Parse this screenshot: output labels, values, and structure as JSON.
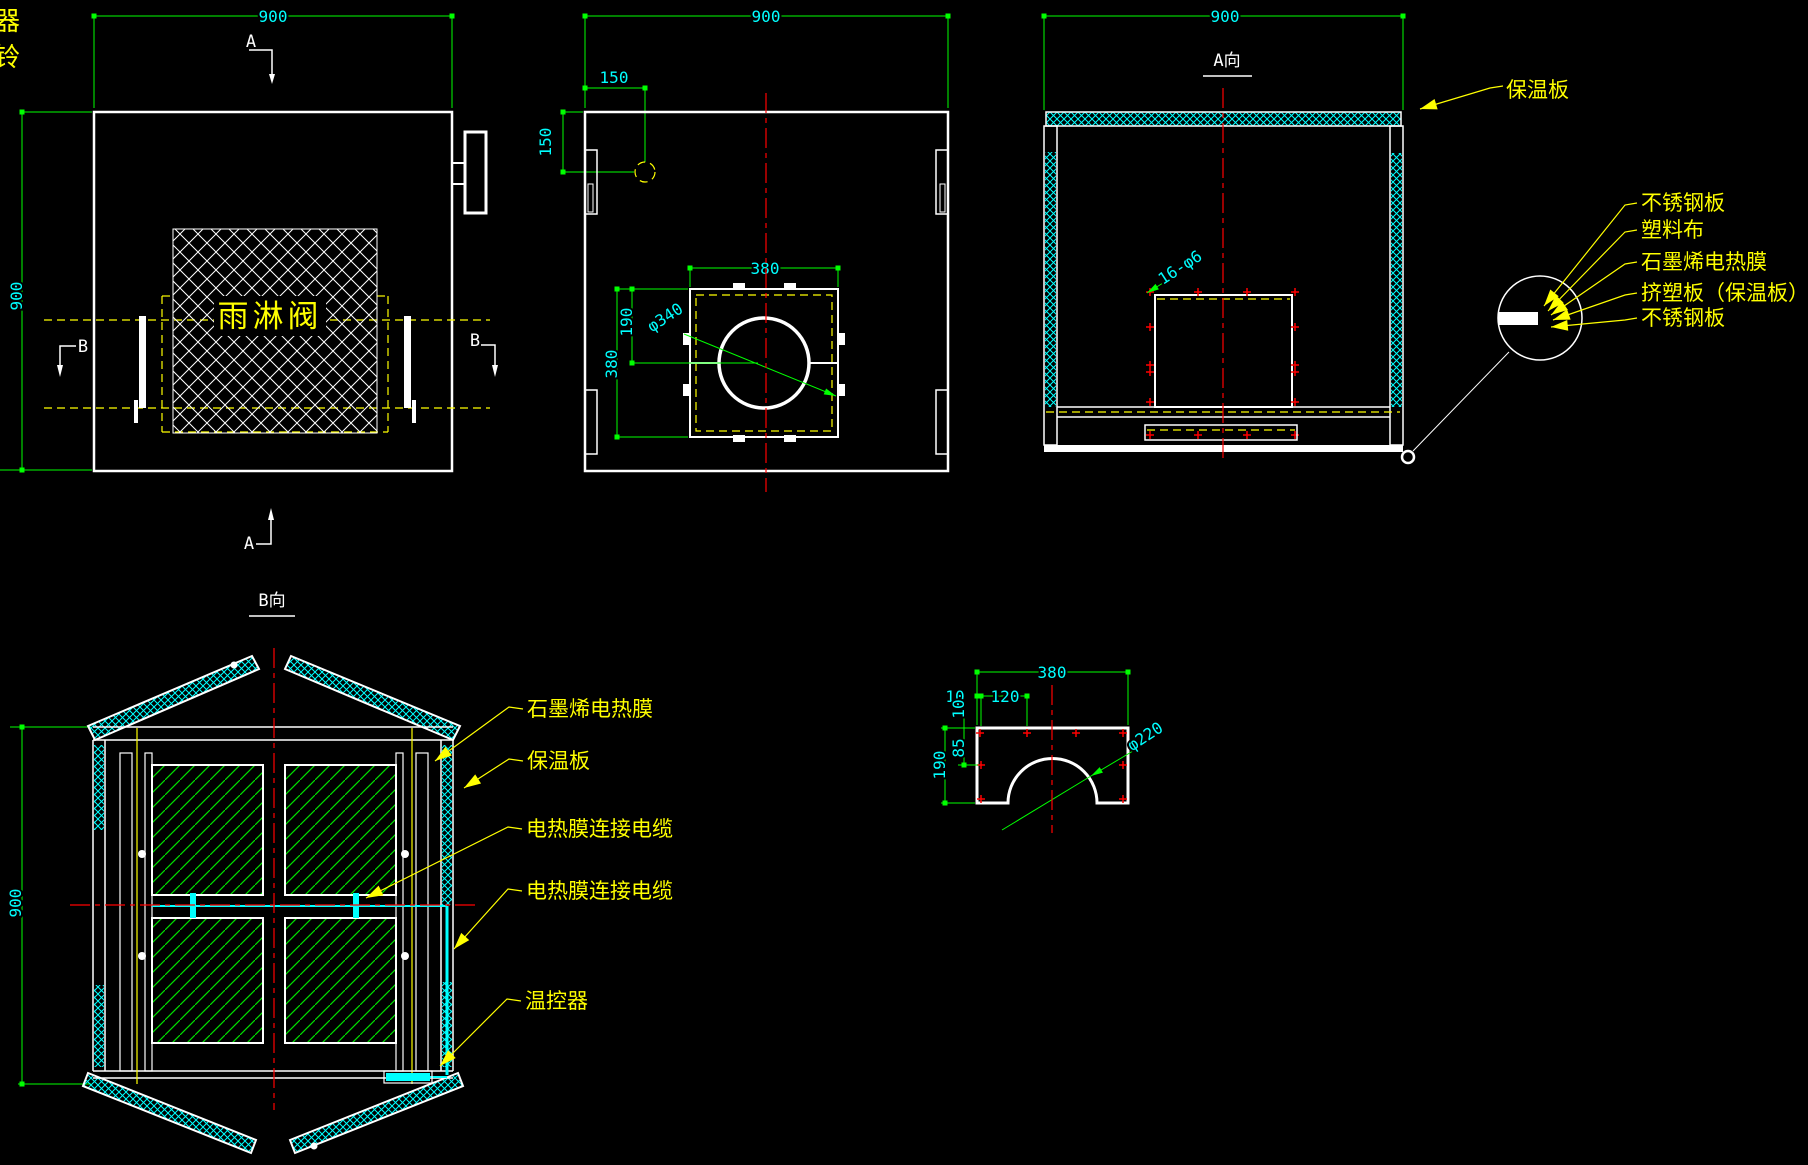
{
  "colors": {
    "background": "#000000",
    "geometry": "#ffffff",
    "dimension_lines": "#00ff00",
    "dimension_text": "#00ffff",
    "labels": "#ffff00",
    "centerlines": "#ff0000",
    "insulation_hatch": "#00ffff",
    "film_hatch": "#00ff00"
  },
  "stray": {
    "char_top": "器",
    "char_bottom": "铃"
  },
  "front_view": {
    "dim_width": "900",
    "dim_height": "900",
    "valve_label": "雨淋阀",
    "section_a": "A",
    "section_b": "B"
  },
  "top_view": {
    "dim_width": "900",
    "dim_offset_x": "150",
    "dim_offset_y": "150",
    "dim_opening_w": "380",
    "dim_opening_h": "380",
    "dim_half": "190",
    "dim_hole": "φ340"
  },
  "a_view": {
    "title": "A向",
    "dim_width": "900",
    "holes_note": "16-φ6",
    "insulation_label": "保温板"
  },
  "layers_callout": {
    "labels": [
      "不锈钢板",
      "塑料布",
      "石墨烯电热膜",
      "挤塑板（保温板）",
      "不锈钢板"
    ]
  },
  "b_view": {
    "title": "B向",
    "dim_height": "900",
    "film_label": "石墨烯电热膜",
    "insulation_label": "保温板",
    "cable_label_top": "电热膜连接电缆",
    "cable_label_bottom": "电热膜连接电缆",
    "thermostat_label": "温控器"
  },
  "flange_part": {
    "dim_width": "380",
    "dim_edge": "10",
    "dim_pitch": "120",
    "dim_top": "10",
    "dim_row": "85",
    "dim_height": "190",
    "dim_arc": "φ220"
  }
}
